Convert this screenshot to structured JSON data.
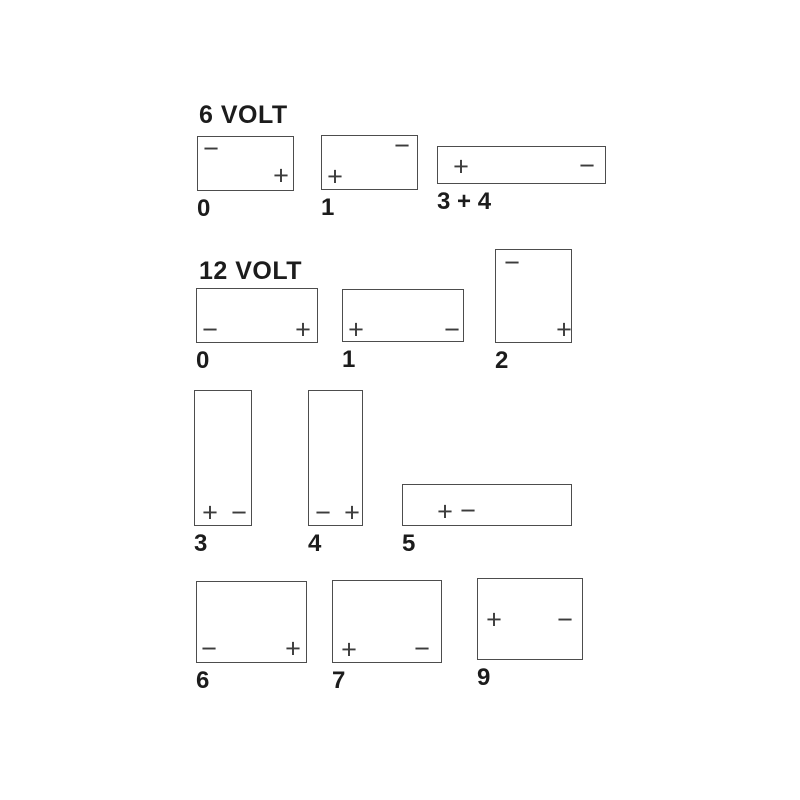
{
  "title": "Battery terminal layout diagram",
  "colors": {
    "background": "#ffffff",
    "outline": "#4d4d4d",
    "sign": "#3c3c3c",
    "text": "#1c1c1c"
  },
  "sections": [
    {
      "id": "6-volt",
      "heading": "6 VOLT",
      "heading_x": 199,
      "heading_y": 103,
      "batteries": [
        {
          "label": "0",
          "box": {
            "x": 197,
            "y": 136,
            "w": 97,
            "h": 55
          },
          "terminals": [
            {
              "sign": "−",
              "polarity": "negative",
              "position": "top-left",
              "dx": 13,
              "dy": 12
            },
            {
              "sign": "+",
              "polarity": "positive",
              "position": "bottom-right",
              "dx": 83,
              "dy": 39
            }
          ]
        },
        {
          "label": "1",
          "box": {
            "x": 321,
            "y": 135,
            "w": 97,
            "h": 55
          },
          "terminals": [
            {
              "sign": "−",
              "polarity": "negative",
              "position": "top-right",
              "dx": 80,
              "dy": 10
            },
            {
              "sign": "+",
              "polarity": "positive",
              "position": "bottom-left",
              "dx": 13,
              "dy": 41
            }
          ]
        },
        {
          "label": "3 + 4",
          "box": {
            "x": 437,
            "y": 146,
            "w": 169,
            "h": 38
          },
          "terminals": [
            {
              "sign": "+",
              "polarity": "positive",
              "position": "mid-left",
              "dx": 23,
              "dy": 20
            },
            {
              "sign": "−",
              "polarity": "negative",
              "position": "mid-right",
              "dx": 149,
              "dy": 19
            }
          ]
        }
      ]
    },
    {
      "id": "12-volt",
      "heading": "12 VOLT",
      "heading_x": 199,
      "heading_y": 259,
      "batteries": [
        {
          "label": "0",
          "box": {
            "x": 196,
            "y": 288,
            "w": 122,
            "h": 55
          },
          "terminals": [
            {
              "sign": "−",
              "polarity": "negative",
              "position": "bottom-left",
              "dx": 13,
              "dy": 41
            },
            {
              "sign": "+",
              "polarity": "positive",
              "position": "bottom-right",
              "dx": 106,
              "dy": 41
            }
          ]
        },
        {
          "label": "1",
          "box": {
            "x": 342,
            "y": 289,
            "w": 122,
            "h": 53
          },
          "terminals": [
            {
              "sign": "+",
              "polarity": "positive",
              "position": "bottom-left",
              "dx": 13,
              "dy": 40
            },
            {
              "sign": "−",
              "polarity": "negative",
              "position": "bottom-right",
              "dx": 109,
              "dy": 40
            }
          ]
        },
        {
          "label": "2",
          "box": {
            "x": 495,
            "y": 249,
            "w": 77,
            "h": 94
          },
          "terminals": [
            {
              "sign": "−",
              "polarity": "negative",
              "position": "top-left",
              "dx": 16,
              "dy": 13
            },
            {
              "sign": "+",
              "polarity": "positive",
              "position": "bottom-right",
              "dx": 68,
              "dy": 80
            }
          ]
        },
        {
          "label": "3",
          "box": {
            "x": 194,
            "y": 390,
            "w": 58,
            "h": 136
          },
          "terminals": [
            {
              "sign": "+",
              "polarity": "positive",
              "position": "bottom-left",
              "dx": 15,
              "dy": 122
            },
            {
              "sign": "−",
              "polarity": "negative",
              "position": "bottom-right",
              "dx": 44,
              "dy": 122
            }
          ]
        },
        {
          "label": "4",
          "box": {
            "x": 308,
            "y": 390,
            "w": 55,
            "h": 136
          },
          "terminals": [
            {
              "sign": "−",
              "polarity": "negative",
              "position": "bottom-left",
              "dx": 14,
              "dy": 122
            },
            {
              "sign": "+",
              "polarity": "positive",
              "position": "bottom-right",
              "dx": 43,
              "dy": 122
            }
          ]
        },
        {
          "label": "5",
          "box": {
            "x": 402,
            "y": 484,
            "w": 170,
            "h": 42
          },
          "terminals": [
            {
              "sign": "+",
              "polarity": "positive",
              "position": "center-left",
              "dx": 42,
              "dy": 27
            },
            {
              "sign": "−",
              "polarity": "negative",
              "position": "center-left",
              "dx": 65,
              "dy": 26
            }
          ]
        },
        {
          "label": "6",
          "box": {
            "x": 196,
            "y": 581,
            "w": 111,
            "h": 82
          },
          "terminals": [
            {
              "sign": "−",
              "polarity": "negative",
              "position": "bottom-left",
              "dx": 12,
              "dy": 67
            },
            {
              "sign": "+",
              "polarity": "positive",
              "position": "bottom-right",
              "dx": 96,
              "dy": 67
            }
          ]
        },
        {
          "label": "7",
          "box": {
            "x": 332,
            "y": 580,
            "w": 110,
            "h": 83
          },
          "terminals": [
            {
              "sign": "+",
              "polarity": "positive",
              "position": "bottom-left",
              "dx": 16,
              "dy": 69
            },
            {
              "sign": "−",
              "polarity": "negative",
              "position": "bottom-right",
              "dx": 89,
              "dy": 68
            }
          ]
        },
        {
          "label": "9",
          "box": {
            "x": 477,
            "y": 578,
            "w": 106,
            "h": 82
          },
          "terminals": [
            {
              "sign": "+",
              "polarity": "positive",
              "position": "mid-left",
              "dx": 16,
              "dy": 41
            },
            {
              "sign": "−",
              "polarity": "negative",
              "position": "mid-right",
              "dx": 87,
              "dy": 41
            }
          ]
        }
      ]
    }
  ]
}
